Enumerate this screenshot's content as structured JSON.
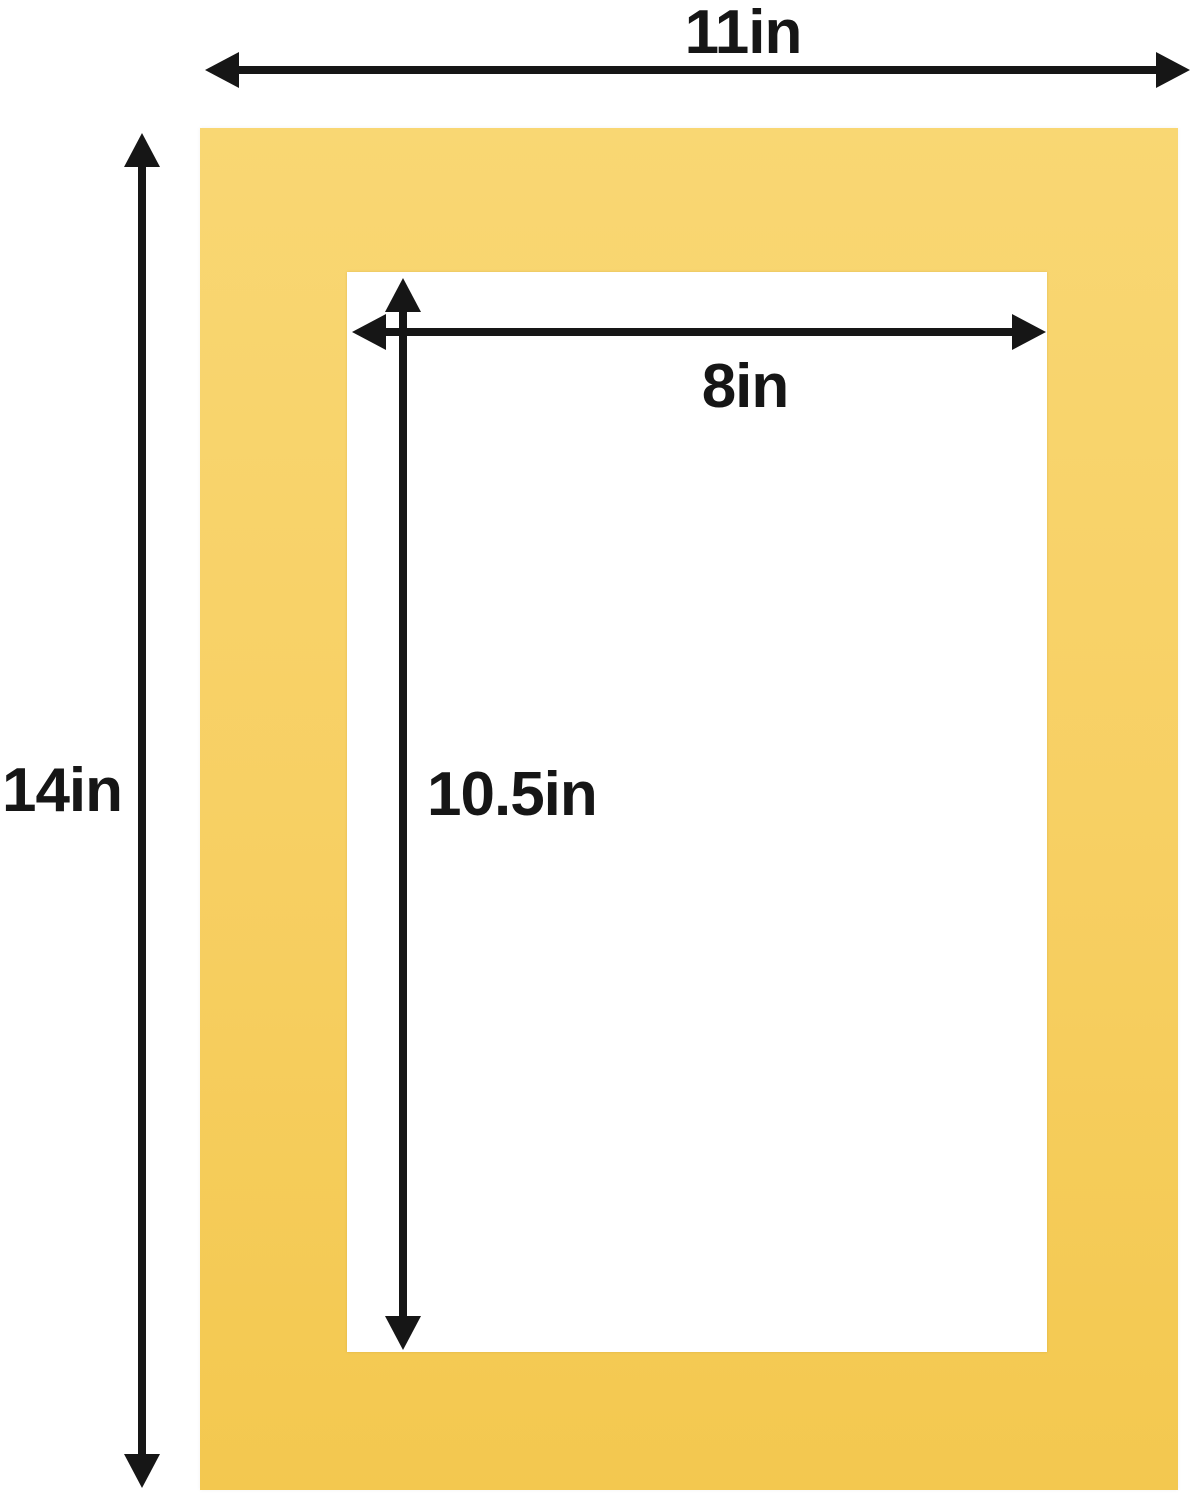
{
  "diagram": {
    "colors": {
      "background": "#FFFFFF",
      "mat_light": "#F9D773",
      "mat": "#F7CF62",
      "mat_deep": "#F3C84F",
      "line": "#161616"
    },
    "dimensions": {
      "outer_width": {
        "label": "11in"
      },
      "outer_height": {
        "label": "14in"
      },
      "opening_width": {
        "label": "8in"
      },
      "opening_height": {
        "label": "10.5in"
      }
    }
  }
}
